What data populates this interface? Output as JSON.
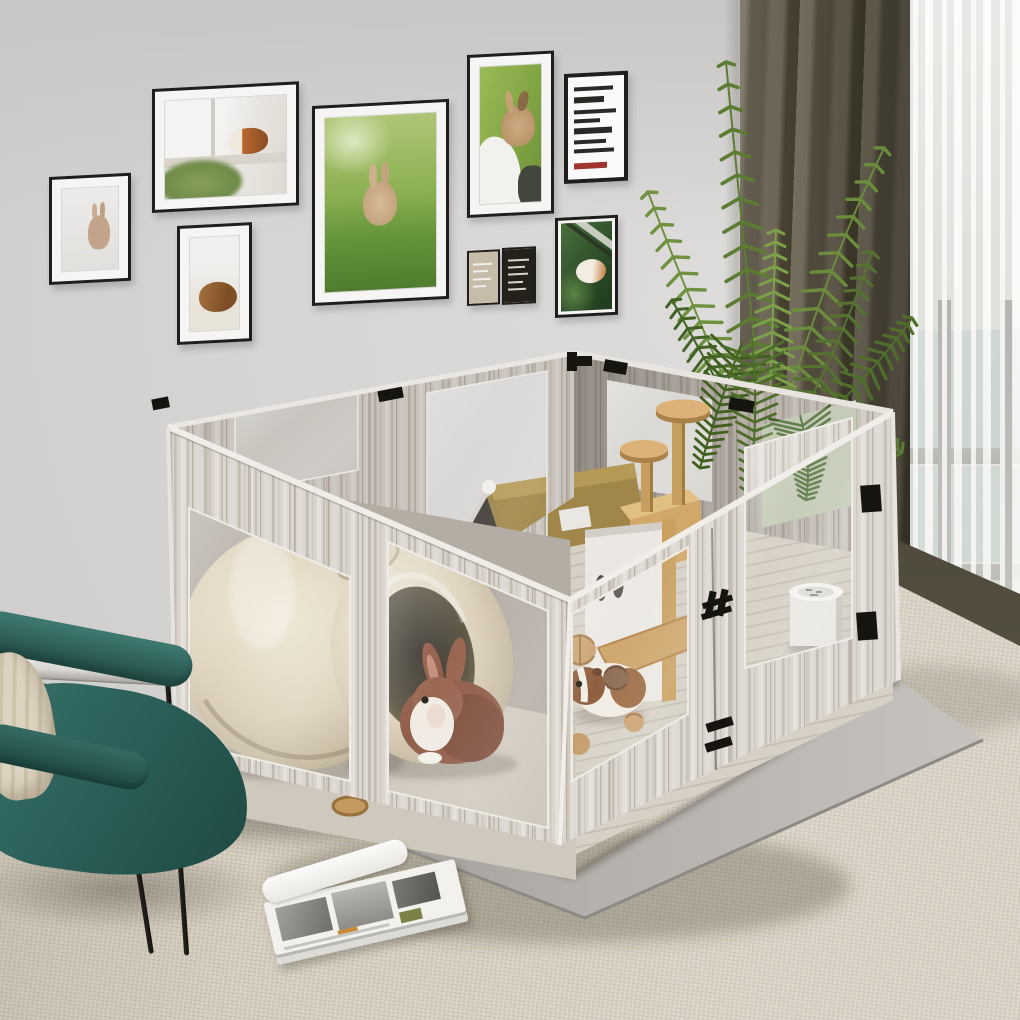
{
  "meta": {
    "type": "product lifestyle photograph",
    "subject": "Whitewashed wood small-animal playpen with clear acrylic windows in a bright living room",
    "visible_text": "none (poster lettering illegible)"
  },
  "palette": {
    "wall": "#d6d5d3",
    "carpet": "#d3cbbc",
    "enclosure_wood": "#d8d2cb",
    "enclosure_interior_wood": "#9a928a",
    "floor_mat": "#b1aea9",
    "dark_floor": "#5a5448",
    "chair_teal": "#2c615b",
    "curtain_dark": "#5c5546",
    "sheer": "#eceae6",
    "window_glass": "#aacdc6",
    "palm_green": "#5d7c33",
    "gold_roof": "#a58a4e",
    "frame_black": "#1f1e1c",
    "hardware_black": "#16140f"
  },
  "wall_gallery": {
    "count": 9,
    "frames": [
      {
        "name": "standing-rabbit",
        "subject": "young rabbit standing upright",
        "type": "photo",
        "orientation": "portrait"
      },
      {
        "name": "guinea-pig-windowsill",
        "subject": "orange and white guinea pig on a windowsill with moss",
        "type": "photo",
        "orientation": "landscape"
      },
      {
        "name": "brown-guinea-pig",
        "subject": "brown guinea pig on a white blanket",
        "type": "photo",
        "orientation": "portrait"
      },
      {
        "name": "rabbit-on-grass",
        "subject": "tan rabbit sitting on green grass",
        "type": "photo",
        "orientation": "portrait"
      },
      {
        "name": "rabbit-in-arms",
        "subject": "rabbit held in a person's arms, green background",
        "type": "photo",
        "orientation": "portrait"
      },
      {
        "name": "typography-poster",
        "subject": "black and white typography poster with red accent, text illegible",
        "type": "poster",
        "orientation": "portrait"
      },
      {
        "name": "beige-mini-poster",
        "subject": "small beige poster with tiny illegible text",
        "type": "poster",
        "orientation": "portrait"
      },
      {
        "name": "black-mini-poster",
        "subject": "small black poster with tiny illegible text",
        "type": "poster",
        "orientation": "portrait"
      },
      {
        "name": "guinea-pig-leaves",
        "subject": "white and orange guinea pig among dark leaves",
        "type": "photo",
        "orientation": "portrait"
      }
    ]
  },
  "enclosure": {
    "material": "whitewashed wood-grain panels with clear acrylic windows",
    "shape": "open-top square pen seen corner-on",
    "hardware": [
      "black corner clips",
      "black door hinge",
      "two black latch plates"
    ],
    "contents": [
      "ceramic dome hideout",
      "tilted ceramic jug hideout",
      "pet house with golden fabric roof and white gable",
      "wooden cat tree with two round platforms",
      "white divider panel with oval cutouts",
      "wooden ramp",
      "round white litter bowl",
      "woven chew balls",
      "small wooden bowl"
    ],
    "animals": [
      {
        "name": "rabbit",
        "desc": "russet and white rabbit facing forward"
      },
      {
        "name": "guinea-pig",
        "desc": "white guinea pig with brown head patch"
      },
      {
        "name": "hidden-guinea-pig",
        "desc": "guinea pig peeking through divider opening"
      }
    ]
  },
  "furniture": {
    "chair": "teal leather lounge chair with thin black metal legs",
    "pillow": "striped beige lumbar pillow",
    "magazine": "magazine stack with black-and-white photo spread",
    "rug": "beige woven area rug",
    "floor": "dark wood floor strip",
    "base_mat": "grey floor protection mat under pen"
  },
  "window_area": {
    "curtains": [
      "dark olive blackout curtain",
      "white sheer curtain"
    ],
    "window": "floor-to-ceiling window with grey mullions and teal tinted glass",
    "plant": "potted areca palm"
  }
}
